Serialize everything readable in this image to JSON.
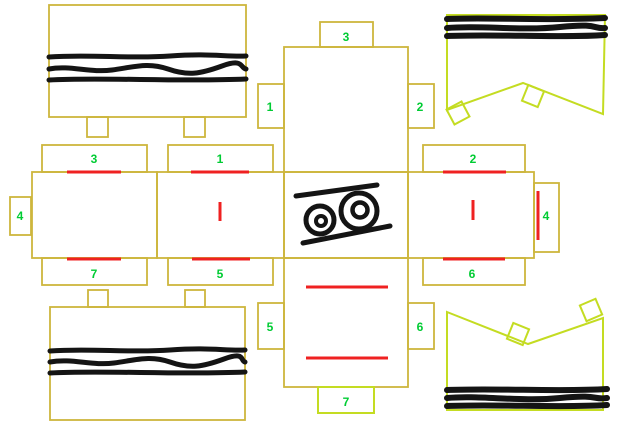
{
  "colors": {
    "background": "#ffffff",
    "outline": "#ceb63d",
    "bright_outline": "#c4dc22",
    "number": "#00cc33",
    "fold_line": "#ef2121",
    "drawing": "#141414"
  },
  "pieces": {
    "strip": {
      "top_tab": "3",
      "left_tab": "1",
      "right_tab": "2",
      "lower_left_tab": "5",
      "lower_right_tab": "6",
      "bottom_tab": "7"
    },
    "row": {
      "left": {
        "top_tab": "3",
        "side_tab": "4",
        "bottom_tab": "7"
      },
      "middle": {
        "top_tab": "1",
        "bottom_tab": "5"
      },
      "right": {
        "top_tab": "2",
        "side_tab": "4",
        "bottom_tab": "6"
      }
    }
  }
}
